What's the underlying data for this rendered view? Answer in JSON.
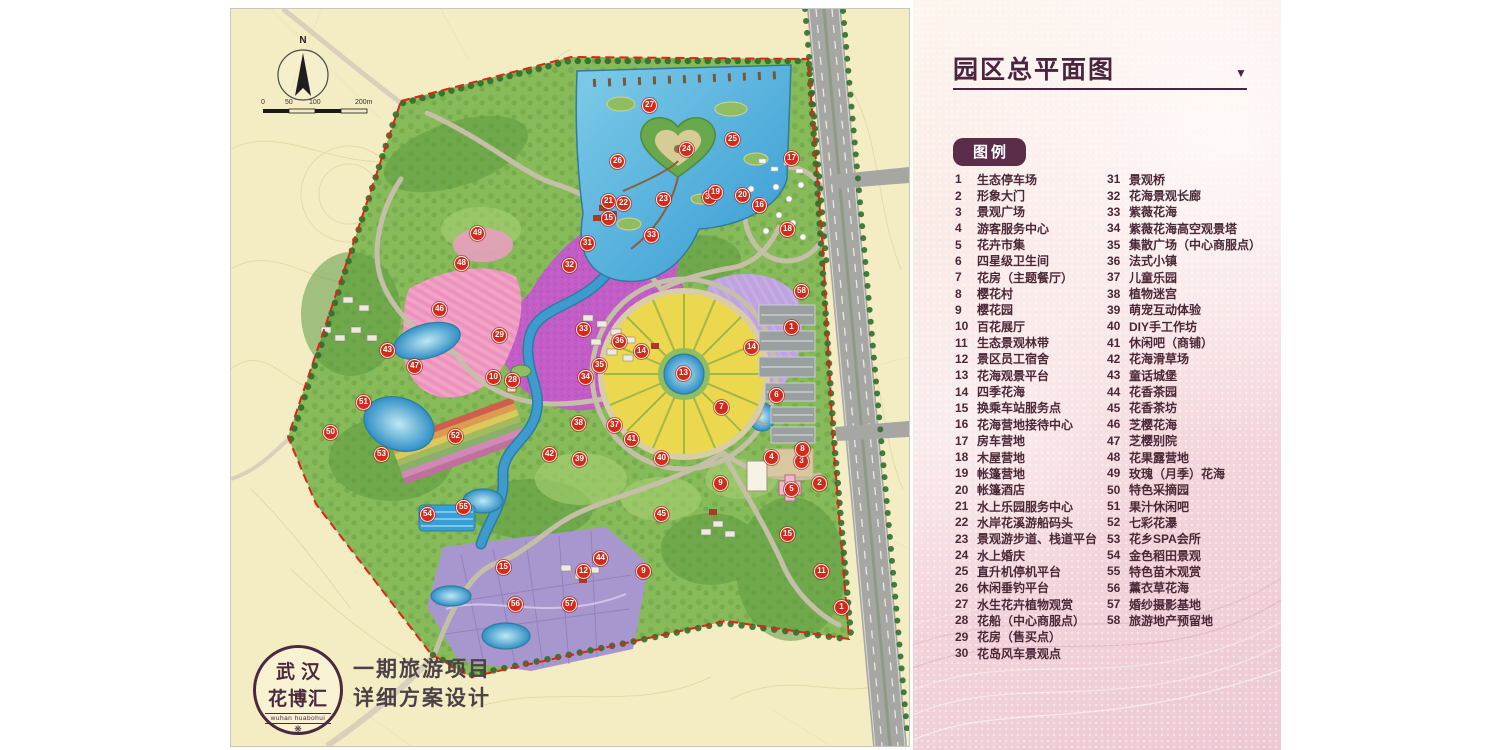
{
  "panel": {
    "title": "园区总平面图",
    "dropdown_icon": "▼",
    "legend_label": "图例",
    "legend_col1": [
      {
        "num": "1",
        "label": "生态停车场"
      },
      {
        "num": "2",
        "label": "形象大门"
      },
      {
        "num": "3",
        "label": "景观广场"
      },
      {
        "num": "4",
        "label": "游客服务中心"
      },
      {
        "num": "5",
        "label": "花卉市集"
      },
      {
        "num": "6",
        "label": "四星级卫生间"
      },
      {
        "num": "7",
        "label": "花房（主题餐厅）"
      },
      {
        "num": "8",
        "label": "樱花村"
      },
      {
        "num": "9",
        "label": "樱花园"
      },
      {
        "num": "10",
        "label": "百花展厅"
      },
      {
        "num": "11",
        "label": "生态景观林带"
      },
      {
        "num": "12",
        "label": "景区员工宿舍"
      },
      {
        "num": "13",
        "label": "花海观景平台"
      },
      {
        "num": "14",
        "label": "四季花海"
      },
      {
        "num": "15",
        "label": "换乘车站服务点"
      },
      {
        "num": "16",
        "label": "花海营地接待中心"
      },
      {
        "num": "17",
        "label": "房车营地"
      },
      {
        "num": "18",
        "label": "木屋营地"
      },
      {
        "num": "19",
        "label": "帐篷营地"
      },
      {
        "num": "20",
        "label": "帐篷酒店"
      },
      {
        "num": "21",
        "label": "水上乐园服务中心"
      },
      {
        "num": "22",
        "label": "水岸花溪游船码头"
      },
      {
        "num": "23",
        "label": "景观游步道、栈道平台"
      },
      {
        "num": "24",
        "label": "水上婚庆"
      },
      {
        "num": "25",
        "label": "直升机停机平台"
      },
      {
        "num": "26",
        "label": "休闲垂钓平台"
      },
      {
        "num": "27",
        "label": "水生花卉植物观赏"
      },
      {
        "num": "28",
        "label": "花船（中心商服点）"
      },
      {
        "num": "29",
        "label": "花房（售买点）"
      },
      {
        "num": "30",
        "label": "花岛风车景观点"
      }
    ],
    "legend_col2": [
      {
        "num": "31",
        "label": "景观桥"
      },
      {
        "num": "32",
        "label": "花海景观长廊"
      },
      {
        "num": "33",
        "label": "紫薇花海"
      },
      {
        "num": "34",
        "label": "紫薇花海高空观景塔"
      },
      {
        "num": "35",
        "label": "集散广场（中心商服点）"
      },
      {
        "num": "36",
        "label": "法式小镇"
      },
      {
        "num": "37",
        "label": "儿童乐园"
      },
      {
        "num": "38",
        "label": "植物迷宫"
      },
      {
        "num": "39",
        "label": "萌宠互动体验"
      },
      {
        "num": "40",
        "label": "DIY手工作坊"
      },
      {
        "num": "41",
        "label": "休闲吧（商铺）"
      },
      {
        "num": "42",
        "label": "花海滑草场"
      },
      {
        "num": "43",
        "label": "童话城堡"
      },
      {
        "num": "44",
        "label": "花香茶园"
      },
      {
        "num": "45",
        "label": "花香茶坊"
      },
      {
        "num": "46",
        "label": "芝樱花海"
      },
      {
        "num": "47",
        "label": "芝樱别院"
      },
      {
        "num": "48",
        "label": "花果露营地"
      },
      {
        "num": "49",
        "label": "玫瑰（月季）花海"
      },
      {
        "num": "50",
        "label": "特色采摘园"
      },
      {
        "num": "51",
        "label": "果汁休闲吧"
      },
      {
        "num": "52",
        "label": "七彩花瀑"
      },
      {
        "num": "53",
        "label": "花乡SPA会所"
      },
      {
        "num": "54",
        "label": "金色稻田景观"
      },
      {
        "num": "55",
        "label": "特色苗木观赏"
      },
      {
        "num": "56",
        "label": "薰衣草花海"
      },
      {
        "num": "57",
        "label": "婚纱摄影基地"
      },
      {
        "num": "58",
        "label": "旅游地产预留地"
      }
    ]
  },
  "map": {
    "compass_label": "N",
    "scale_ticks": [
      "0",
      "50",
      "100",
      "200m"
    ],
    "logo": {
      "line1": "武汉",
      "line2": "花博汇",
      "sub": "wuhan huabohui",
      "flower_icon": "❋"
    },
    "project_line1": "一期旅游项目",
    "project_line2": "详细方案设计",
    "markers": [
      {
        "n": "27",
        "x": 418,
        "y": 96
      },
      {
        "n": "24",
        "x": 455,
        "y": 140
      },
      {
        "n": "25",
        "x": 501,
        "y": 130
      },
      {
        "n": "26",
        "x": 386,
        "y": 152
      },
      {
        "n": "21",
        "x": 377,
        "y": 192
      },
      {
        "n": "22",
        "x": 392,
        "y": 194
      },
      {
        "n": "15",
        "x": 377,
        "y": 209
      },
      {
        "n": "23",
        "x": 432,
        "y": 190
      },
      {
        "n": "30",
        "x": 478,
        "y": 188
      },
      {
        "n": "19",
        "x": 484,
        "y": 183
      },
      {
        "n": "20",
        "x": 511,
        "y": 186
      },
      {
        "n": "16",
        "x": 528,
        "y": 196
      },
      {
        "n": "17",
        "x": 560,
        "y": 149
      },
      {
        "n": "18",
        "x": 556,
        "y": 220
      },
      {
        "n": "58",
        "x": 570,
        "y": 282
      },
      {
        "n": "31",
        "x": 356,
        "y": 234
      },
      {
        "n": "32",
        "x": 338,
        "y": 256
      },
      {
        "n": "33",
        "x": 420,
        "y": 226
      },
      {
        "n": "33",
        "x": 352,
        "y": 320
      },
      {
        "n": "34",
        "x": 354,
        "y": 368
      },
      {
        "n": "35",
        "x": 368,
        "y": 356
      },
      {
        "n": "36",
        "x": 388,
        "y": 332
      },
      {
        "n": "13",
        "x": 452,
        "y": 364
      },
      {
        "n": "14",
        "x": 410,
        "y": 342
      },
      {
        "n": "14",
        "x": 520,
        "y": 338
      },
      {
        "n": "1",
        "x": 560,
        "y": 318
      },
      {
        "n": "2",
        "x": 588,
        "y": 474
      },
      {
        "n": "3",
        "x": 570,
        "y": 452
      },
      {
        "n": "8",
        "x": 571,
        "y": 440
      },
      {
        "n": "4",
        "x": 540,
        "y": 448
      },
      {
        "n": "5",
        "x": 560,
        "y": 480
      },
      {
        "n": "6",
        "x": 545,
        "y": 386
      },
      {
        "n": "7",
        "x": 490,
        "y": 398
      },
      {
        "n": "9",
        "x": 489,
        "y": 474
      },
      {
        "n": "9",
        "x": 412,
        "y": 562
      },
      {
        "n": "10",
        "x": 262,
        "y": 368
      },
      {
        "n": "28",
        "x": 281,
        "y": 371
      },
      {
        "n": "29",
        "x": 268,
        "y": 326
      },
      {
        "n": "46",
        "x": 208,
        "y": 300
      },
      {
        "n": "47",
        "x": 183,
        "y": 357
      },
      {
        "n": "48",
        "x": 230,
        "y": 254
      },
      {
        "n": "49",
        "x": 246,
        "y": 224
      },
      {
        "n": "43",
        "x": 156,
        "y": 341
      },
      {
        "n": "50",
        "x": 99,
        "y": 423
      },
      {
        "n": "51",
        "x": 132,
        "y": 393
      },
      {
        "n": "52",
        "x": 224,
        "y": 427
      },
      {
        "n": "53",
        "x": 150,
        "y": 445
      },
      {
        "n": "54",
        "x": 196,
        "y": 505
      },
      {
        "n": "55",
        "x": 232,
        "y": 498
      },
      {
        "n": "56",
        "x": 284,
        "y": 595
      },
      {
        "n": "57",
        "x": 338,
        "y": 595
      },
      {
        "n": "12",
        "x": 352,
        "y": 562
      },
      {
        "n": "37",
        "x": 383,
        "y": 416
      },
      {
        "n": "38",
        "x": 347,
        "y": 414
      },
      {
        "n": "39",
        "x": 348,
        "y": 450
      },
      {
        "n": "40",
        "x": 430,
        "y": 449
      },
      {
        "n": "41",
        "x": 400,
        "y": 430
      },
      {
        "n": "42",
        "x": 318,
        "y": 445
      },
      {
        "n": "44",
        "x": 369,
        "y": 549
      },
      {
        "n": "45",
        "x": 430,
        "y": 505
      },
      {
        "n": "11",
        "x": 590,
        "y": 562
      },
      {
        "n": "15",
        "x": 272,
        "y": 558
      },
      {
        "n": "15",
        "x": 556,
        "y": 525
      },
      {
        "n": "1",
        "x": 610,
        "y": 598
      }
    ]
  },
  "colors": {
    "boundary_red": "#dd2517",
    "panel_text": "#4b2838",
    "badge_bg": "#5b2d49",
    "title_text": "#4b2440",
    "lake_blue": "#3f9fd8",
    "magenta_field": "#c25cc6",
    "yellow_field": "#ecd84f",
    "lavender_field": "#a896ce",
    "park_green": "#87ba58",
    "beige_ground": "#f4edc4",
    "marker_red": "#d42a1c"
  }
}
